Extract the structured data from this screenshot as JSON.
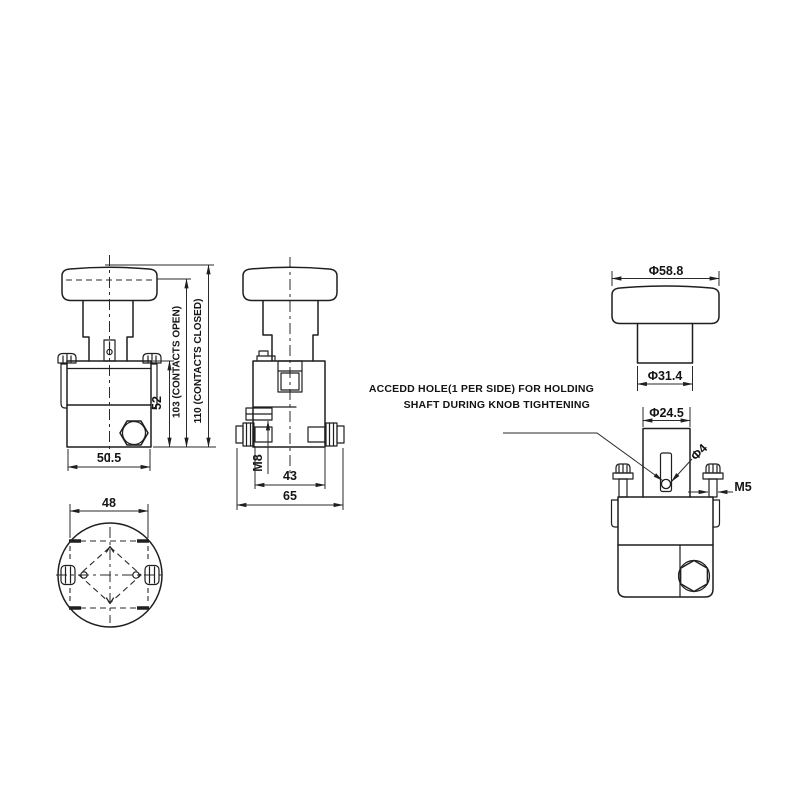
{
  "annotation": {
    "line1": "ACCEDD HOLE(1 PER SIDE) FOR HOLDING",
    "line2": "SHAFT DURING KNOB TIGHTENING"
  },
  "front_view": {
    "width_label": "50.5",
    "body_height_label": "52",
    "contacts_open_label": "103 (CONTACTS OPEN)",
    "contacts_closed_label": "110 (CONTACTS CLOSED)"
  },
  "side_view": {
    "terminal_label": "M8",
    "inner_width_label": "43",
    "outer_width_label": "65"
  },
  "bottom_view": {
    "width_label": "48"
  },
  "right_view": {
    "knob_dia_label": "Φ58.8",
    "shaft_dia_label": "Φ31.4",
    "boss_dia_label": "Φ24.5",
    "hole_dia_label": "Φ4",
    "screw_label": "M5"
  },
  "colors": {
    "line": "#1f1f1f",
    "background": "#ffffff"
  }
}
